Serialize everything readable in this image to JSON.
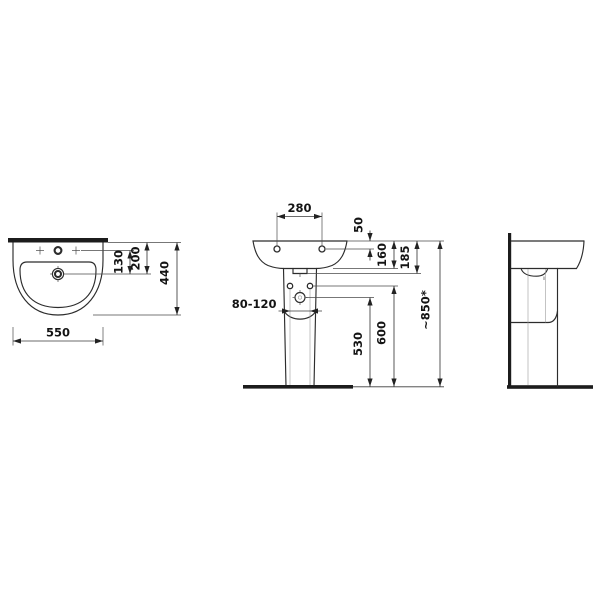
{
  "colors": {
    "background": "#ffffff",
    "line": "#2c2c2c",
    "dimension_line": "#3a3a3a",
    "text": "#141414"
  },
  "dimensions": {
    "basin_width": "550",
    "basin_depth": "440",
    "tap_to_drain": "130",
    "back_edge_to_drain": "200",
    "fixing_holes_spacing": "280",
    "rim_to_fixing_holes": "50",
    "rim_to_underside": "160",
    "rim_to_siphon_cover": "185",
    "supply_spacing": "80-120",
    "drain_height": "530",
    "supply_height": "600",
    "rim_height": "~850*"
  }
}
